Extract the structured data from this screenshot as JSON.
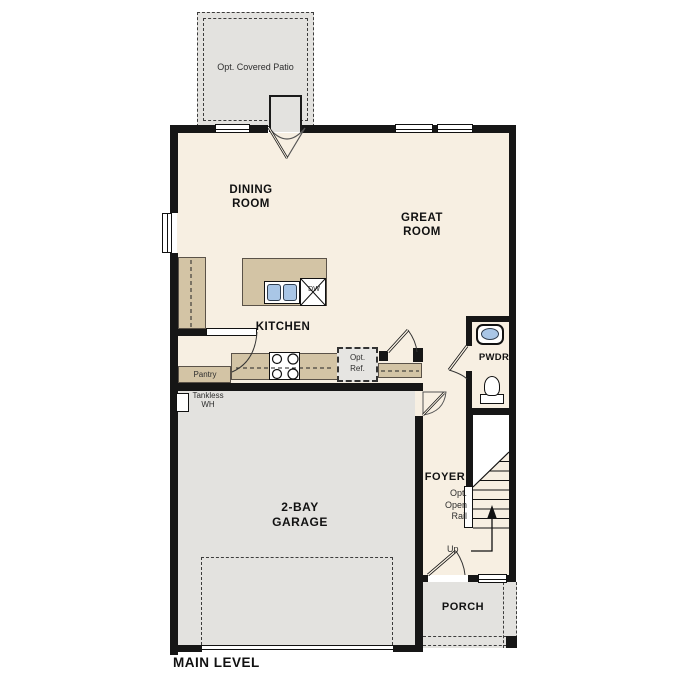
{
  "title": "MAIN LEVEL",
  "labels": {
    "patio": "Opt. Covered Patio",
    "dining": [
      "DINING",
      "ROOM"
    ],
    "great": [
      "GREAT",
      "ROOM"
    ],
    "kitchen": "KITCHEN",
    "pwdr": "PWDR",
    "foyer": "FOYER",
    "garage": [
      "2-BAY",
      "GARAGE"
    ],
    "porch": "PORCH",
    "pantry": "Pantry",
    "tankless": [
      "Tankless",
      "WH"
    ],
    "opt_ref": [
      "Opt.",
      "Ref."
    ],
    "opt_open_rail": [
      "Opt.",
      "Open",
      "Rail"
    ],
    "up": "Up",
    "dw": "DW"
  },
  "colors": {
    "floor": "#f7efe2",
    "hardscape": "#e3e2df",
    "counter": "#d3c4a5",
    "wall": "#161616",
    "fixture_blue": "#a9c6e6"
  }
}
